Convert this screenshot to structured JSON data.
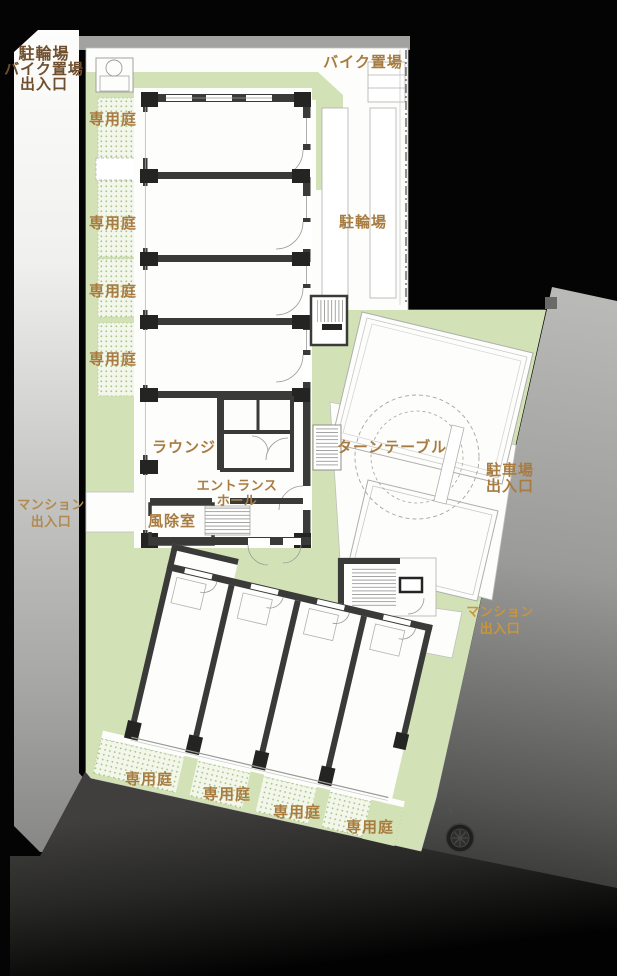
{
  "floorplan": {
    "type": "residential-site-plan",
    "labels": {
      "bike_moto_entrance": {
        "lines": [
          "駐輪場",
          "バイク置場",
          "出入口"
        ]
      },
      "moto_storage": "バイク置場",
      "bicycle_storage": "駐輪場",
      "private_garden": "専用庭",
      "lounge": "ラウンジ",
      "turntable": "ターンテーブル",
      "parking_entrance": {
        "lines": [
          "駐車場",
          "出入口"
        ]
      },
      "entrance_hall": {
        "lines": [
          "エントランス",
          "ホール"
        ]
      },
      "windbreak_room": "風除室",
      "mansion_entrance": {
        "lines": [
          "マンション",
          "出入口"
        ]
      }
    },
    "counts": {
      "private_garden_left": 4,
      "private_garden_bottom": 4
    },
    "colors": {
      "label": "#a87c40",
      "label_dark": "#6f4f2e",
      "label_road_left": "#b08a50",
      "label_road_right": "#c9953e",
      "garden_green": "#d3e2b6",
      "garden_dotted_bg": "#f3f7eb",
      "wall_dark": "#3a3a38",
      "site_white": "#fdfdfc"
    }
  }
}
